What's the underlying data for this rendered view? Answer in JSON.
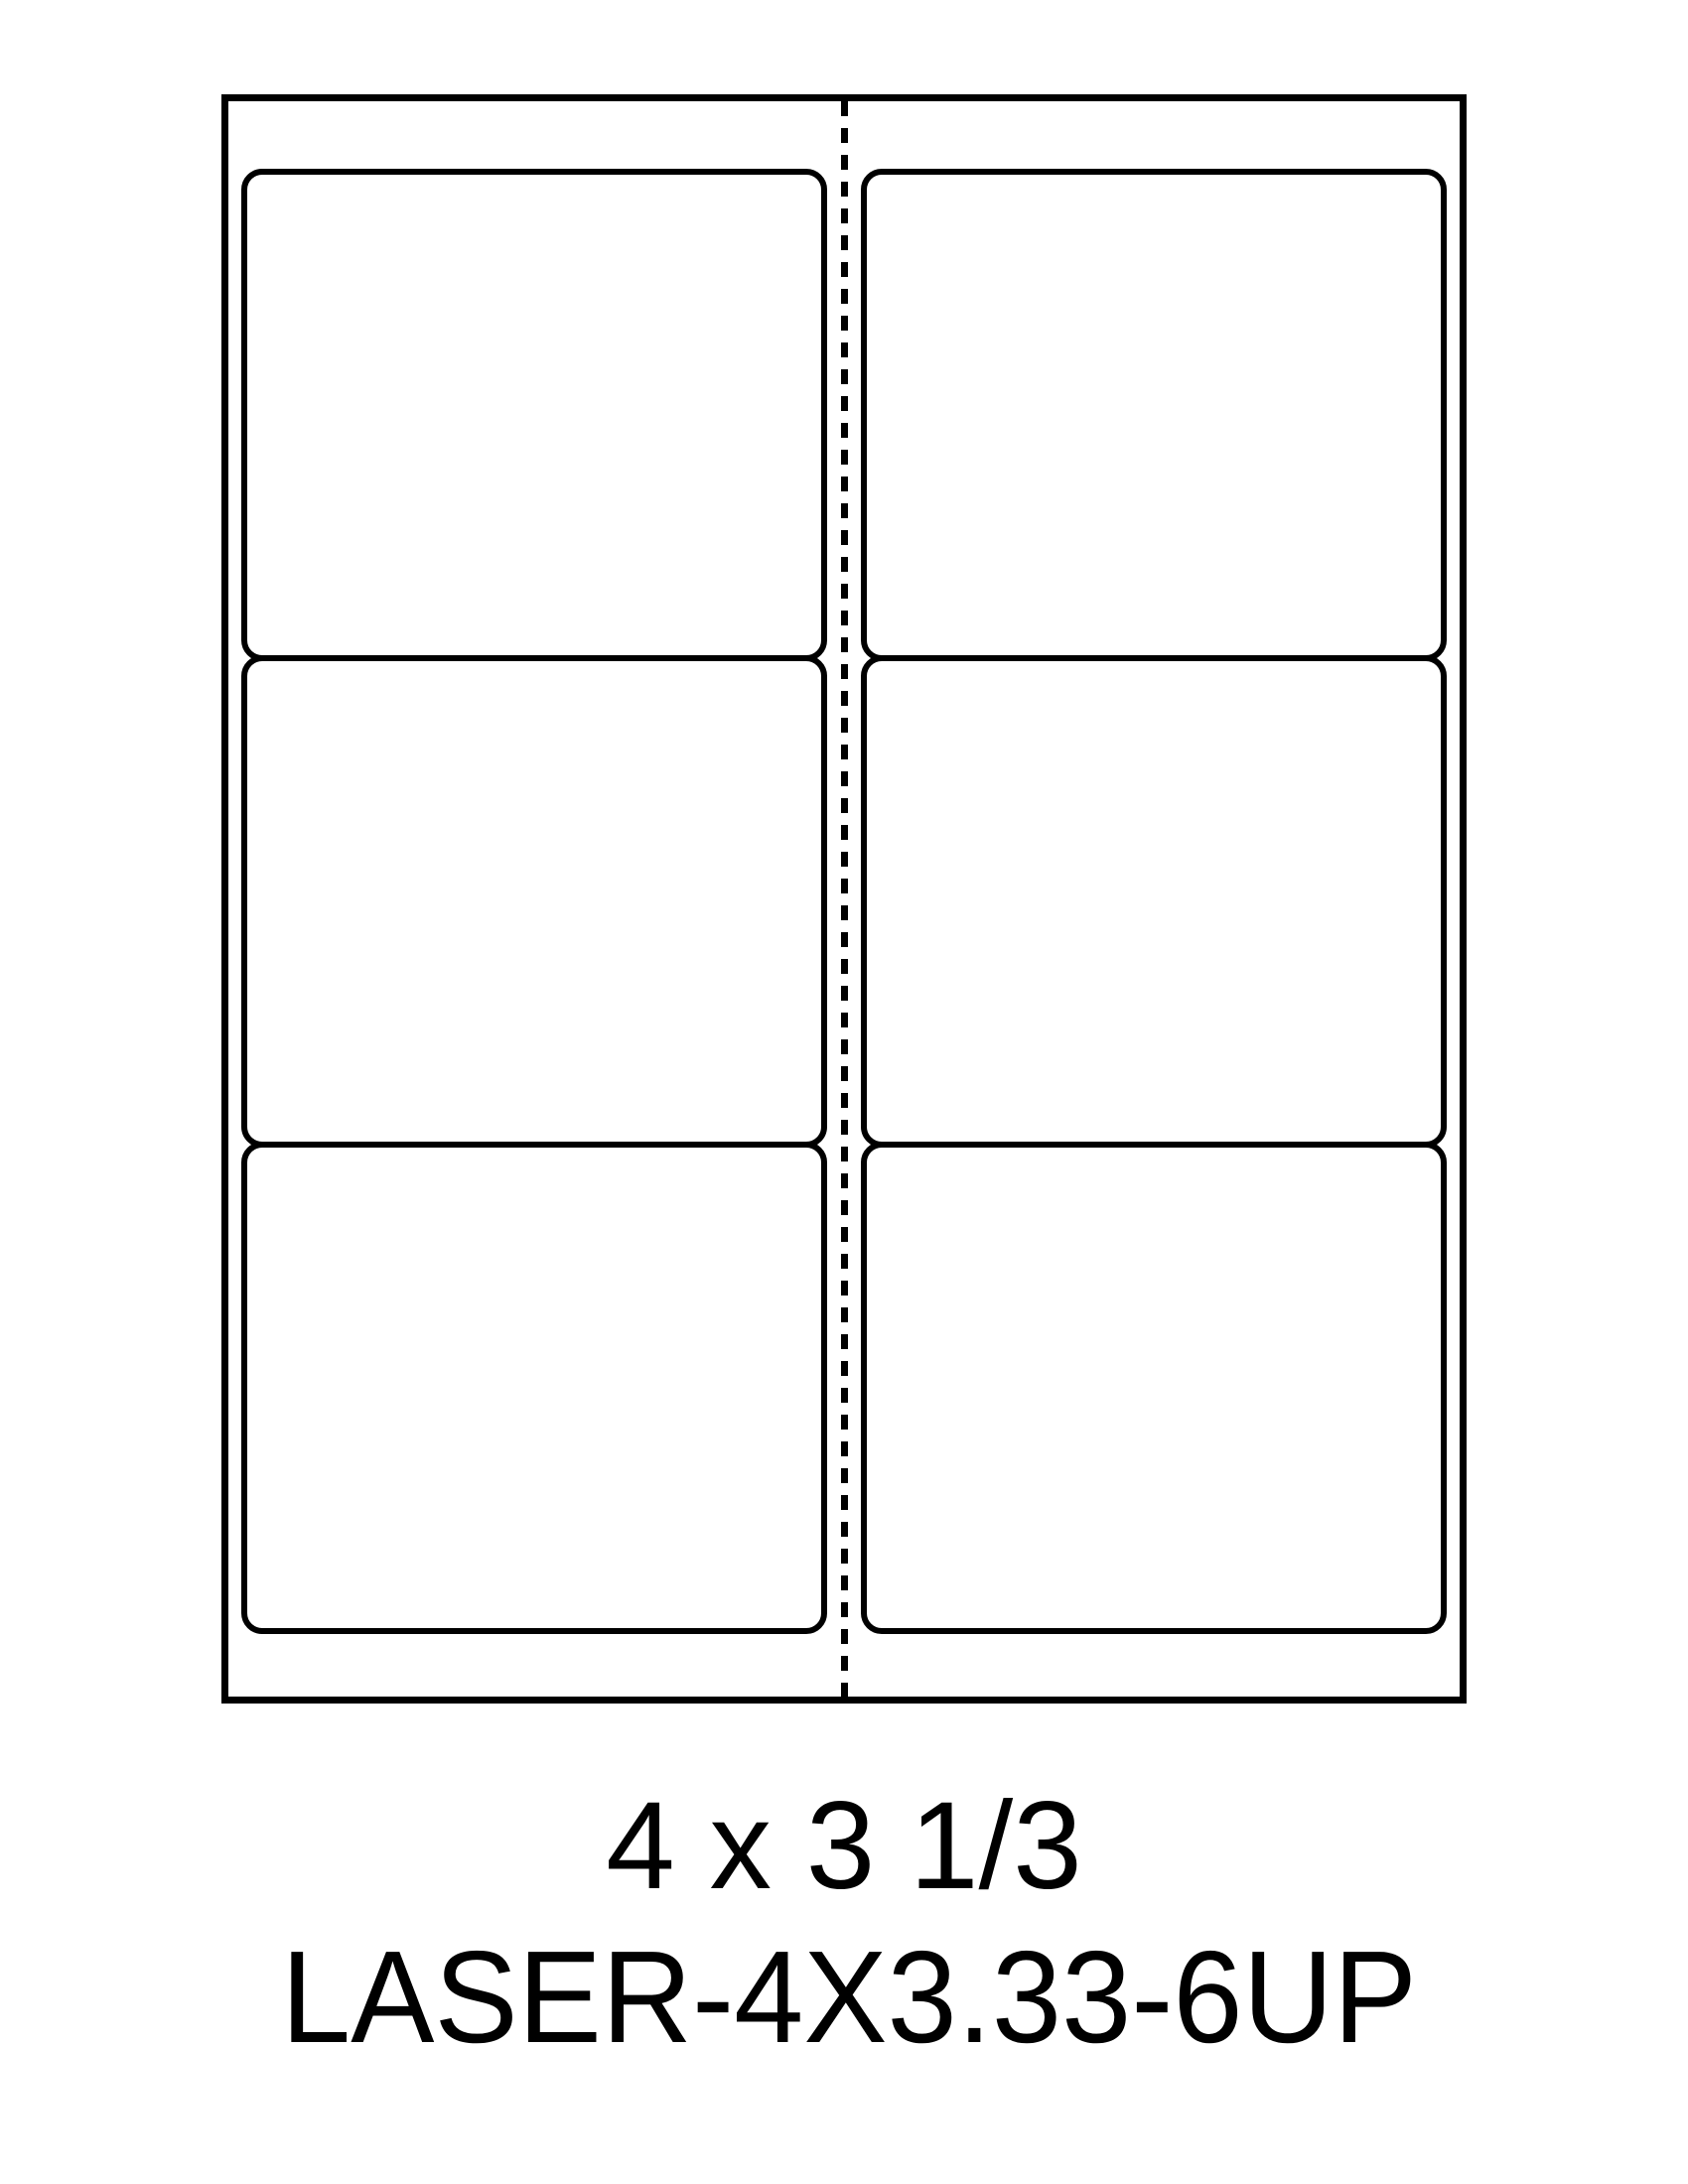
{
  "page": {
    "background_color": "#ffffff",
    "line_color": "#000000"
  },
  "template_diagram": {
    "caption": {
      "size_label": "4 x 3 1/3",
      "template_name": "LASER-4X3.33-6UP"
    },
    "sheet": {
      "columns": 2,
      "rows": 3,
      "label_count": 6,
      "divider_style": "dashed-vertical-center",
      "cells": [
        {
          "row": 1,
          "col": 1,
          "content": ""
        },
        {
          "row": 1,
          "col": 2,
          "content": ""
        },
        {
          "row": 2,
          "col": 1,
          "content": ""
        },
        {
          "row": 2,
          "col": 2,
          "content": ""
        },
        {
          "row": 3,
          "col": 1,
          "content": ""
        },
        {
          "row": 3,
          "col": 2,
          "content": ""
        }
      ]
    }
  }
}
